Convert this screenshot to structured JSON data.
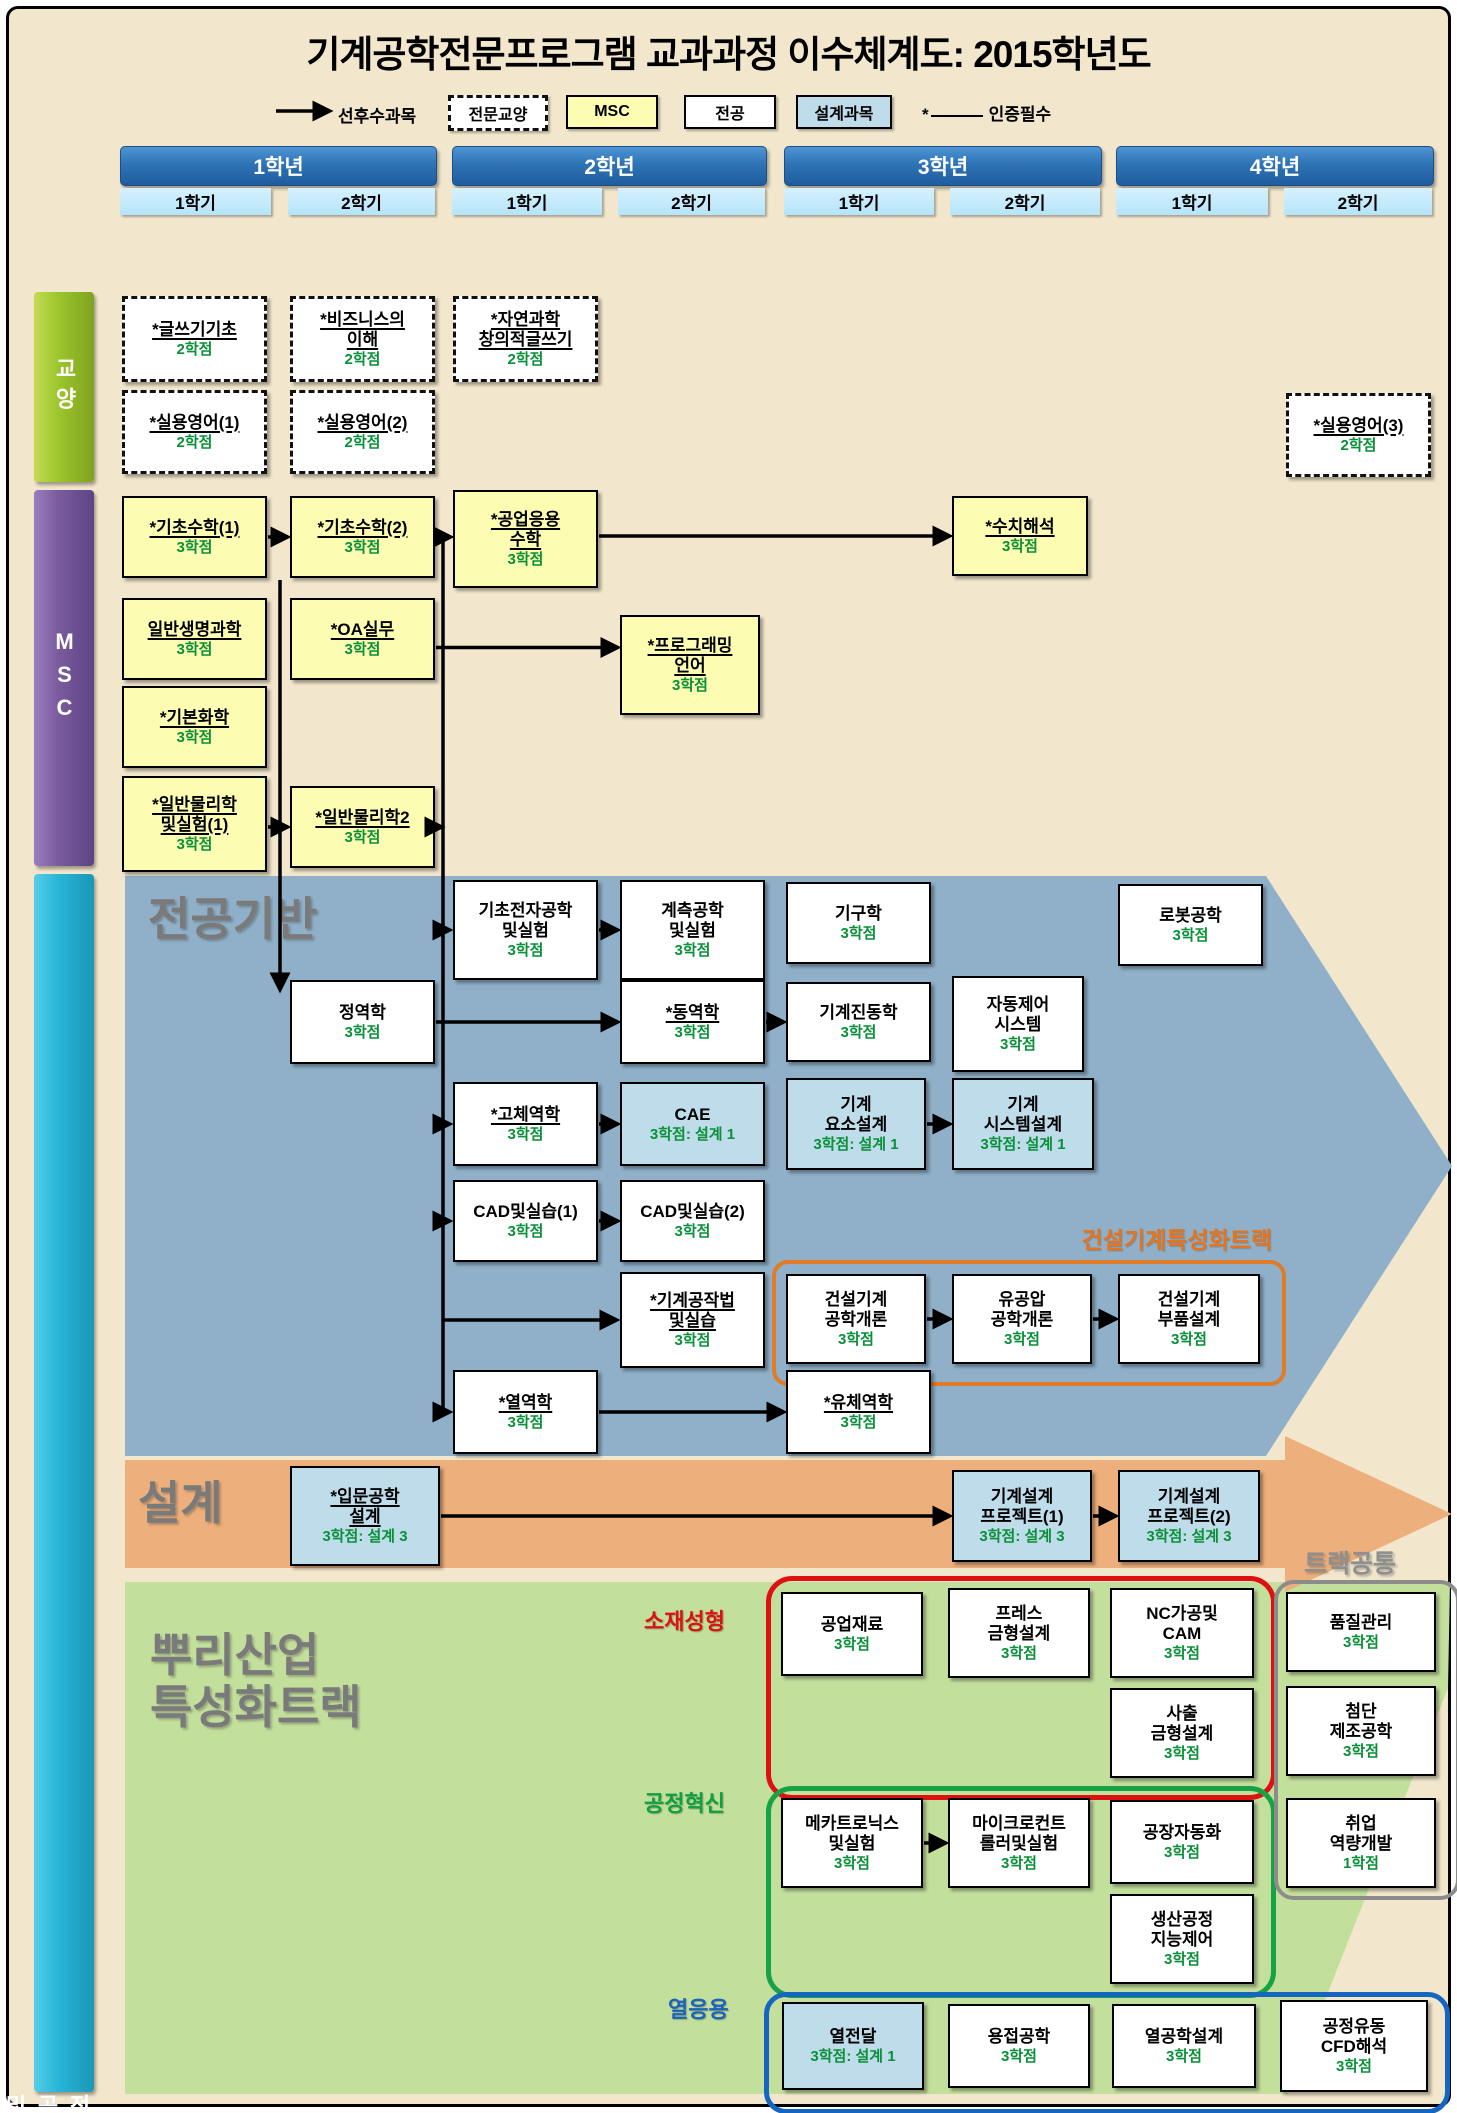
{
  "title": "기계공학전문프로그램 교과과정 이수체계도: 2015학년도",
  "legend": {
    "arrow_label": "선후수과목",
    "items": [
      {
        "label": "전문교양",
        "type": "ge"
      },
      {
        "label": "MSC",
        "type": "msc"
      },
      {
        "label": "전공",
        "type": "major"
      },
      {
        "label": "설계과목",
        "type": "design"
      }
    ],
    "star_symbol": "*",
    "star_label": "인증필수"
  },
  "grid": {
    "years": [
      {
        "label": "1학년",
        "semesters": [
          "1학기",
          "2학기"
        ]
      },
      {
        "label": "2학년",
        "semesters": [
          "1학기",
          "2학기"
        ]
      },
      {
        "label": "3학년",
        "semesters": [
          "1학기",
          "2학기"
        ]
      },
      {
        "label": "4학년",
        "semesters": [
          "1학기",
          "2학기"
        ]
      }
    ]
  },
  "sidebars": [
    {
      "id": "ge",
      "label": "교양"
    },
    {
      "id": "msc",
      "label": "MSC"
    },
    {
      "id": "major",
      "label": "전공 및 설계"
    }
  ],
  "sections": {
    "major_base": "전공기반",
    "design_band": "설계",
    "root_track": [
      "뿌리산업",
      "특성화트랙"
    ],
    "construction_track": "건설기계특성화트랙",
    "track_common": "트랙공통",
    "material_forming": "소재성형",
    "process_innovation": "공정혁신",
    "thermal_application": "열응용"
  },
  "colors": {
    "background": "#F2E7CC",
    "msc_box": "#FCFCB2",
    "major_box": "#FFFFFF",
    "design_box": "#BFDCEB",
    "zone_major_base": "#8FB0C8",
    "zone_design": "#EDAF7B",
    "zone_root_track": "#C3DF9C",
    "credit_text": "#0A9038",
    "accent_orange": "#E07B28",
    "accent_red": "#DD1111",
    "accent_green": "#17A245",
    "accent_blue": "#1566C0"
  },
  "courses": [
    {
      "id": "writing1",
      "lines": [
        "*글쓰기기초"
      ],
      "credit": "2학점",
      "type": "ge",
      "u": true,
      "x": 122,
      "y": 296,
      "w": 145,
      "h": 86
    },
    {
      "id": "business",
      "lines": [
        "*비즈니스의",
        "이해"
      ],
      "credit": "2학점",
      "type": "ge",
      "u": true,
      "x": 290,
      "y": 296,
      "w": 145,
      "h": 86
    },
    {
      "id": "sciwriting",
      "lines": [
        "*자연과학",
        "창의적글쓰기"
      ],
      "credit": "2학점",
      "type": "ge",
      "u": true,
      "x": 453,
      "y": 296,
      "w": 145,
      "h": 86
    },
    {
      "id": "eng1",
      "lines": [
        "*실용영어(1)"
      ],
      "credit": "2학점",
      "type": "ge",
      "u": true,
      "x": 122,
      "y": 390,
      "w": 145,
      "h": 84
    },
    {
      "id": "eng2",
      "lines": [
        "*실용영어(2)"
      ],
      "credit": "2학점",
      "type": "ge",
      "u": true,
      "x": 290,
      "y": 390,
      "w": 145,
      "h": 84
    },
    {
      "id": "eng3",
      "lines": [
        "*실용영어(3)"
      ],
      "credit": "2학점",
      "type": "ge",
      "u": true,
      "x": 1286,
      "y": 393,
      "w": 145,
      "h": 84
    },
    {
      "id": "math1",
      "lines": [
        "*기초수학(1)"
      ],
      "credit": "3학점",
      "type": "msc",
      "u": true,
      "x": 122,
      "y": 496,
      "w": 145,
      "h": 82
    },
    {
      "id": "math2",
      "lines": [
        "*기초수학(2)"
      ],
      "credit": "3학점",
      "type": "msc",
      "u": true,
      "x": 290,
      "y": 496,
      "w": 145,
      "h": 82
    },
    {
      "id": "engmath",
      "lines": [
        "*공업응용",
        "수학"
      ],
      "credit": "3학점",
      "type": "msc",
      "u": true,
      "x": 453,
      "y": 490,
      "w": 145,
      "h": 98
    },
    {
      "id": "numanal",
      "lines": [
        "*수치해석"
      ],
      "credit": "3학점",
      "type": "msc",
      "u": true,
      "x": 952,
      "y": 496,
      "w": 136,
      "h": 80
    },
    {
      "id": "biosci",
      "lines": [
        "일반생명과학"
      ],
      "credit": "3학점",
      "type": "msc",
      "u": true,
      "x": 122,
      "y": 598,
      "w": 145,
      "h": 82
    },
    {
      "id": "oa",
      "lines": [
        "*OA실무"
      ],
      "credit": "3학점",
      "type": "msc",
      "u": true,
      "x": 290,
      "y": 598,
      "w": 145,
      "h": 82
    },
    {
      "id": "prog",
      "lines": [
        "*프로그래밍",
        "언어"
      ],
      "credit": "3학점",
      "type": "msc",
      "u": true,
      "x": 620,
      "y": 615,
      "w": 140,
      "h": 100
    },
    {
      "id": "chem",
      "lines": [
        "*기본화학"
      ],
      "credit": "3학점",
      "type": "msc",
      "u": true,
      "x": 122,
      "y": 686,
      "w": 145,
      "h": 82
    },
    {
      "id": "phys1",
      "lines": [
        "*일반물리학",
        "및실험(1)"
      ],
      "credit": "3학점",
      "type": "msc",
      "u": true,
      "x": 122,
      "y": 776,
      "w": 145,
      "h": 96
    },
    {
      "id": "phys2",
      "lines": [
        "*일반물리학2"
      ],
      "credit": "3학점",
      "type": "msc",
      "u": true,
      "x": 290,
      "y": 786,
      "w": 145,
      "h": 82
    },
    {
      "id": "elec",
      "lines": [
        "기초전자공학",
        "및실험"
      ],
      "credit": "3학점",
      "type": "major",
      "u": false,
      "x": 453,
      "y": 880,
      "w": 145,
      "h": 100
    },
    {
      "id": "instr",
      "lines": [
        "계측공학",
        "및실험"
      ],
      "credit": "3학점",
      "type": "major",
      "u": false,
      "x": 620,
      "y": 880,
      "w": 145,
      "h": 100
    },
    {
      "id": "kinematics",
      "lines": [
        "기구학"
      ],
      "credit": "3학점",
      "type": "major",
      "u": false,
      "x": 786,
      "y": 882,
      "w": 145,
      "h": 82
    },
    {
      "id": "robot",
      "lines": [
        "로봇공학"
      ],
      "credit": "3학점",
      "type": "major",
      "u": false,
      "x": 1118,
      "y": 884,
      "w": 145,
      "h": 82
    },
    {
      "id": "statics",
      "lines": [
        "정역학"
      ],
      "credit": "3학점",
      "type": "major",
      "u": false,
      "x": 290,
      "y": 980,
      "w": 145,
      "h": 84
    },
    {
      "id": "dynamics",
      "lines": [
        "*동역학"
      ],
      "credit": "3학점",
      "type": "major",
      "u": true,
      "x": 620,
      "y": 980,
      "w": 145,
      "h": 84
    },
    {
      "id": "vibration",
      "lines": [
        "기계진동학"
      ],
      "credit": "3학점",
      "type": "major",
      "u": false,
      "x": 786,
      "y": 982,
      "w": 145,
      "h": 80
    },
    {
      "id": "autocontrol",
      "lines": [
        "자동제어",
        "시스템"
      ],
      "credit": "3학점",
      "type": "major",
      "u": false,
      "x": 952,
      "y": 976,
      "w": 132,
      "h": 96
    },
    {
      "id": "solid",
      "lines": [
        "*고체역학"
      ],
      "credit": "3학점",
      "type": "major",
      "u": true,
      "x": 453,
      "y": 1082,
      "w": 145,
      "h": 84
    },
    {
      "id": "cae",
      "lines": [
        "CAE"
      ],
      "credit": "3학점: 설계 1",
      "type": "design",
      "u": false,
      "x": 620,
      "y": 1082,
      "w": 145,
      "h": 84
    },
    {
      "id": "machelem",
      "lines": [
        "기계",
        "요소설계"
      ],
      "credit": "3학점: 설계 1",
      "type": "design",
      "u": false,
      "x": 786,
      "y": 1078,
      "w": 140,
      "h": 92
    },
    {
      "id": "machsys",
      "lines": [
        "기계",
        "시스템설계"
      ],
      "credit": "3학점: 설계 1",
      "type": "design",
      "u": false,
      "x": 952,
      "y": 1078,
      "w": 142,
      "h": 92
    },
    {
      "id": "cad1",
      "lines": [
        "CAD및실습(1)"
      ],
      "credit": "3학점",
      "type": "major",
      "u": false,
      "x": 453,
      "y": 1180,
      "w": 145,
      "h": 82
    },
    {
      "id": "cad2",
      "lines": [
        "CAD및실습(2)"
      ],
      "credit": "3학점",
      "type": "major",
      "u": false,
      "x": 620,
      "y": 1180,
      "w": 145,
      "h": 82
    },
    {
      "id": "machining",
      "lines": [
        "*기계공작법",
        "및실습"
      ],
      "credit": "3학점",
      "type": "major",
      "u": true,
      "x": 620,
      "y": 1272,
      "w": 145,
      "h": 96
    },
    {
      "id": "constintro",
      "lines": [
        "건설기계",
        "공학개론"
      ],
      "credit": "3학점",
      "type": "major",
      "u": false,
      "x": 786,
      "y": 1274,
      "w": 140,
      "h": 90
    },
    {
      "id": "hydraulic",
      "lines": [
        "유공압",
        "공학개론"
      ],
      "credit": "3학점",
      "type": "major",
      "u": false,
      "x": 952,
      "y": 1274,
      "w": 140,
      "h": 90
    },
    {
      "id": "constparts",
      "lines": [
        "건설기계",
        "부품설계"
      ],
      "credit": "3학점",
      "type": "major",
      "u": false,
      "x": 1118,
      "y": 1274,
      "w": 142,
      "h": 90
    },
    {
      "id": "thermo",
      "lines": [
        "*열역학"
      ],
      "credit": "3학점",
      "type": "major",
      "u": true,
      "x": 453,
      "y": 1370,
      "w": 145,
      "h": 84
    },
    {
      "id": "fluid",
      "lines": [
        "*유체역학"
      ],
      "credit": "3학점",
      "type": "major",
      "u": true,
      "x": 786,
      "y": 1370,
      "w": 145,
      "h": 84
    },
    {
      "id": "introdesign",
      "lines": [
        "*입문공학",
        "설계"
      ],
      "credit": "3학점: 설계 3",
      "type": "design",
      "u": true,
      "x": 290,
      "y": 1466,
      "w": 150,
      "h": 100
    },
    {
      "id": "proj1",
      "lines": [
        "기계설계",
        "프로젝트(1)"
      ],
      "credit": "3학점: 설계 3",
      "type": "design",
      "u": false,
      "x": 952,
      "y": 1470,
      "w": 140,
      "h": 92
    },
    {
      "id": "proj2",
      "lines": [
        "기계설계",
        "프로젝트(2)"
      ],
      "credit": "3학점: 설계 3",
      "type": "design",
      "u": false,
      "x": 1118,
      "y": 1470,
      "w": 142,
      "h": 92
    },
    {
      "id": "indmat",
      "lines": [
        "공업재료"
      ],
      "credit": "3학점",
      "type": "major",
      "u": false,
      "x": 781,
      "y": 1592,
      "w": 142,
      "h": 84
    },
    {
      "id": "press",
      "lines": [
        "프레스",
        "금형설계"
      ],
      "credit": "3학점",
      "type": "major",
      "u": false,
      "x": 948,
      "y": 1588,
      "w": 142,
      "h": 90
    },
    {
      "id": "nccam",
      "lines": [
        "NC가공및",
        "CAM"
      ],
      "credit": "3학점",
      "type": "major",
      "u": false,
      "x": 1110,
      "y": 1588,
      "w": 144,
      "h": 90
    },
    {
      "id": "injection",
      "lines": [
        "사출",
        "금형설계"
      ],
      "credit": "3학점",
      "type": "major",
      "u": false,
      "x": 1110,
      "y": 1688,
      "w": 144,
      "h": 90
    },
    {
      "id": "quality",
      "lines": [
        "품질관리"
      ],
      "credit": "3학점",
      "type": "major",
      "u": false,
      "x": 1286,
      "y": 1592,
      "w": 150,
      "h": 80
    },
    {
      "id": "advmfg",
      "lines": [
        "첨단",
        "제조공학"
      ],
      "credit": "3학점",
      "type": "major",
      "u": false,
      "x": 1286,
      "y": 1686,
      "w": 150,
      "h": 90
    },
    {
      "id": "career",
      "lines": [
        "취업",
        "역량개발"
      ],
      "credit": "1학점",
      "type": "major",
      "u": false,
      "x": 1286,
      "y": 1798,
      "w": 150,
      "h": 90
    },
    {
      "id": "mecha",
      "lines": [
        "메카트로닉스",
        "및실험"
      ],
      "credit": "3학점",
      "type": "major",
      "u": false,
      "x": 781,
      "y": 1798,
      "w": 142,
      "h": 90
    },
    {
      "id": "micro",
      "lines": [
        "마이크로컨트",
        "롤러및실험"
      ],
      "credit": "3학점",
      "type": "major",
      "u": false,
      "x": 948,
      "y": 1798,
      "w": 142,
      "h": 90
    },
    {
      "id": "factauto",
      "lines": [
        "공장자동화"
      ],
      "credit": "3학점",
      "type": "major",
      "u": false,
      "x": 1110,
      "y": 1800,
      "w": 144,
      "h": 84
    },
    {
      "id": "prodproc",
      "lines": [
        "생산공정",
        "지능제어"
      ],
      "credit": "3학점",
      "type": "major",
      "u": false,
      "x": 1110,
      "y": 1894,
      "w": 144,
      "h": 90
    },
    {
      "id": "heattrans",
      "lines": [
        "열전달"
      ],
      "credit": "3학점: 설계 1",
      "type": "design",
      "u": false,
      "x": 782,
      "y": 2002,
      "w": 142,
      "h": 88
    },
    {
      "id": "welding",
      "lines": [
        "용접공학"
      ],
      "credit": "3학점",
      "type": "major",
      "u": false,
      "x": 948,
      "y": 2004,
      "w": 142,
      "h": 84
    },
    {
      "id": "thermdesign",
      "lines": [
        "열공학설계"
      ],
      "credit": "3학점",
      "type": "major",
      "u": false,
      "x": 1112,
      "y": 2004,
      "w": 144,
      "h": 84
    },
    {
      "id": "cfd",
      "lines": [
        "공정유동",
        "CFD해석"
      ],
      "credit": "3학점",
      "type": "major",
      "u": false,
      "x": 1280,
      "y": 2000,
      "w": 148,
      "h": 92
    }
  ],
  "arrows": [
    {
      "from": "math1",
      "to": "math2"
    },
    {
      "from": "math2",
      "to": "engmath"
    },
    {
      "from": "engmath",
      "to": "numanal"
    },
    {
      "from": "oa",
      "to": "prog"
    },
    {
      "from": "phys1",
      "to": "phys2"
    },
    {
      "from": "elec",
      "to": "instr"
    },
    {
      "from": "statics",
      "to": "dynamics"
    },
    {
      "from": "dynamics",
      "to": "vibration"
    },
    {
      "from": "solid",
      "to": "cae"
    },
    {
      "from": "machelem",
      "to": "machsys"
    },
    {
      "from": "cad1",
      "to": "cad2"
    },
    {
      "from": "constintro",
      "to": "hydraulic"
    },
    {
      "from": "hydraulic",
      "to": "constparts"
    },
    {
      "from": "thermo",
      "to": "fluid"
    },
    {
      "from": "introdesign",
      "to": "proj1"
    },
    {
      "from": "proj1",
      "to": "proj2"
    },
    {
      "from": "mecha",
      "to": "micro"
    }
  ]
}
